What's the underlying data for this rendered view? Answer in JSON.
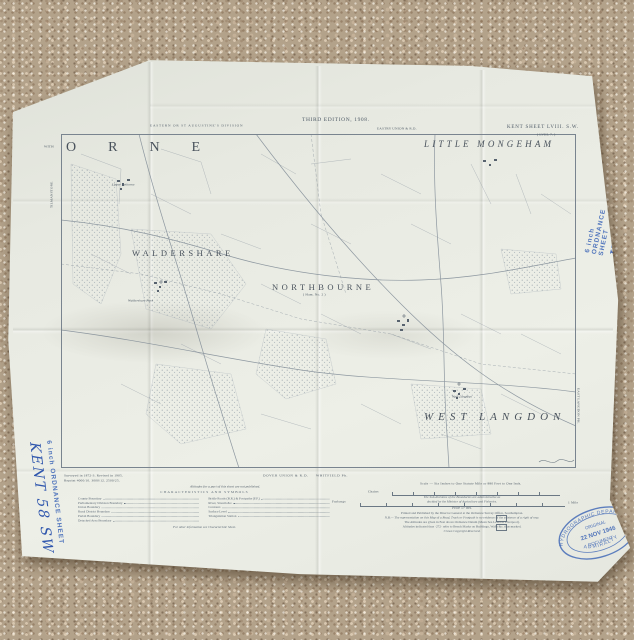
{
  "colors": {
    "carpet": "#b3a28a",
    "paper": "#e8eae2",
    "map_ink": "#5d6a77",
    "annotation_blue": "#3a5fb0"
  },
  "sheet_header": {
    "division": "EASTERN OR ST AUGUSTINE'S DIVISION",
    "edition": "THIRD EDITION, 1908.",
    "union_rd": "EASTRY UNION & R.D.",
    "sheet_title": "KENT SHEET LVIII. S.W.",
    "sheet_subtitle": "( LVIII. 7. )"
  },
  "parish_names": {
    "orne": "ORNE",
    "little_mongeham": "LITTLE MONGEHAM",
    "waldershare": "WALDERSHARE",
    "northbourne": "NORTHBOURNE",
    "northbourne_sub": "( Ham. No. 2 )",
    "west_langdon": "WEST LANGDON"
  },
  "village_names": {
    "upper_eythorne": "Upper Eythorne",
    "waldershare_park": "Waldershare Park",
    "west_langdon": "West Langdon"
  },
  "margin_text": {
    "with_label": "WITH",
    "left_vertical": "TILMANSTONE",
    "right_vertical": "EAST LANGDON PH.",
    "survey_note_1": "Surveyed in 1872-3.  Revised in 1905.",
    "survey_note_2": "Reprint 4000/10. 3000/12. 2500/25.",
    "dover_union": "DOVER UNION & R.D.",
    "whitfield": "WHITFIELD Ph.",
    "altitude_note": "Altitudes for a part of this sheet are not published.",
    "scale_caption": "Scale — Six Inches to One Statute Mile or 880 Feet to One Inch.",
    "chains": "Chains",
    "furlongs": "Furlongs",
    "mile": "1 Mile"
  },
  "legend": {
    "title": "CHARACTERISTICS AND SYMBOLS",
    "left": [
      "County Boundary",
      "Parliamentary Division Boundary",
      "Union Boundary",
      "Rural District Boundary",
      "Parish Boundary",
      "Detached Area Boundary"
    ],
    "right": [
      "Bridle Roads (B.R.) & Footpaths (F.P.)",
      "River, Stream &c.",
      "Contours",
      "Surface Level",
      "Triangulation Station"
    ],
    "footnote": "For other information see Characteristic Sheet."
  },
  "imprint": {
    "boundaries_1": "The Sub-divisions of the Boundaries are administrative as",
    "boundaries_2": "decided by the Minister of Agriculture and Fisheries.",
    "price": "Price 1/- net.",
    "publisher": "Printed and Published by the Director General at the Ordnance Survey Office, Southampton.",
    "nb": "N.B.— The representation on this Map of a Road, Track or Footpath is no evidence of the existence of a right of way.",
    "altitudes": "The Altitudes are given in Feet above Ordnance Datum (Mean Sea Level at Liverpool).",
    "bench": "Altitudes indicated thus ·272· refer to Bench Marks on Buildings, Walls &c. thus marked.",
    "copyright": "Crown Copyright Reserved."
  },
  "blue_annotations": {
    "stamp_text": "6 inch ORDNANCE SHEET",
    "handwritten": "KENT 58 SW"
  },
  "oval_stamp": {
    "arc_top": "HYDROGRAPHIC DEPARTMENT",
    "center_1": "ORIGINAL",
    "center_2": "22 NOV 1946",
    "center_3": "DOCUMENT",
    "arc_bottom": "ADMIRALTY"
  }
}
